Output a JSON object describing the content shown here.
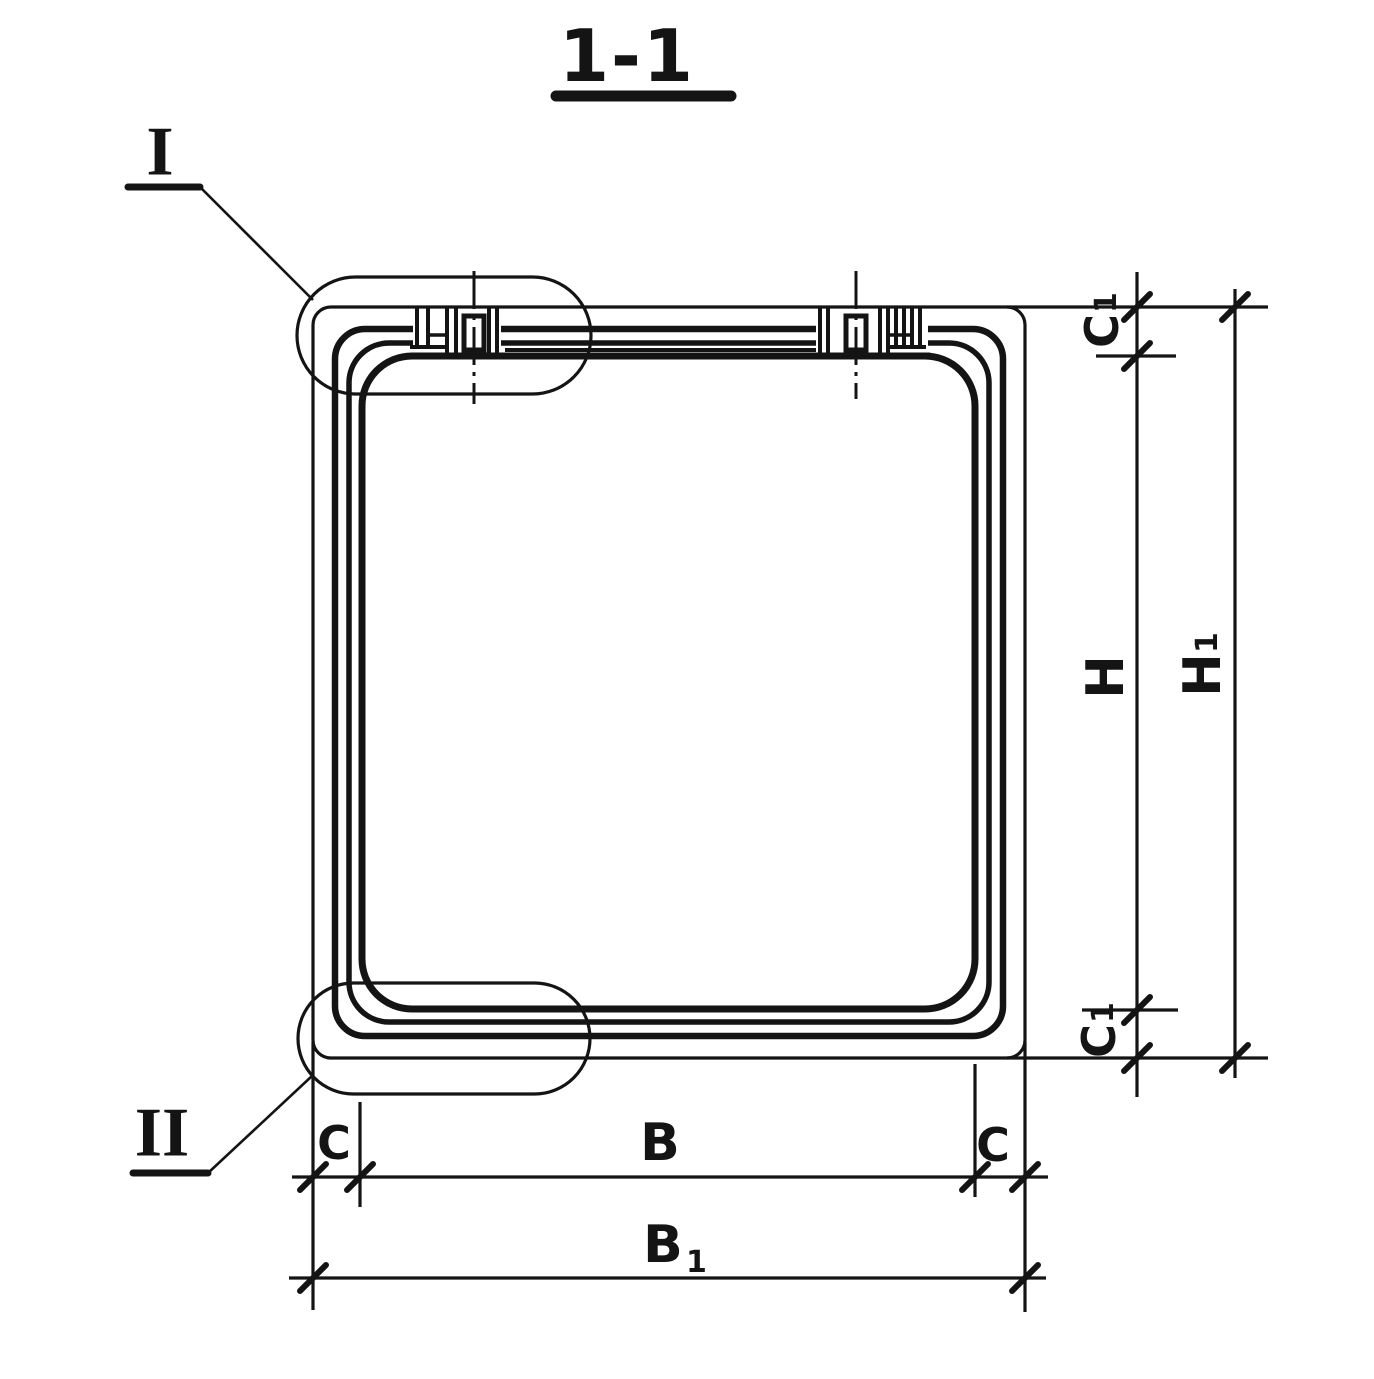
{
  "drawing": {
    "kind": "technical-section-drawing",
    "title": "1-1",
    "detail_markers": {
      "top": "I",
      "bottom": "II"
    },
    "dim_labels": {
      "c1_top": {
        "base": "C",
        "sub": "1"
      },
      "h": {
        "base": "H"
      },
      "h1": {
        "base": "H",
        "sub": "1"
      },
      "c1_bottom": {
        "base": "C",
        "sub": "1"
      },
      "c_left": {
        "base": "C"
      },
      "b": {
        "base": "B"
      },
      "c_right": {
        "base": "C"
      },
      "b1": {
        "base": "B",
        "sub": "1"
      }
    },
    "ink_color": "#141414",
    "paper_color": "#ffffff"
  }
}
